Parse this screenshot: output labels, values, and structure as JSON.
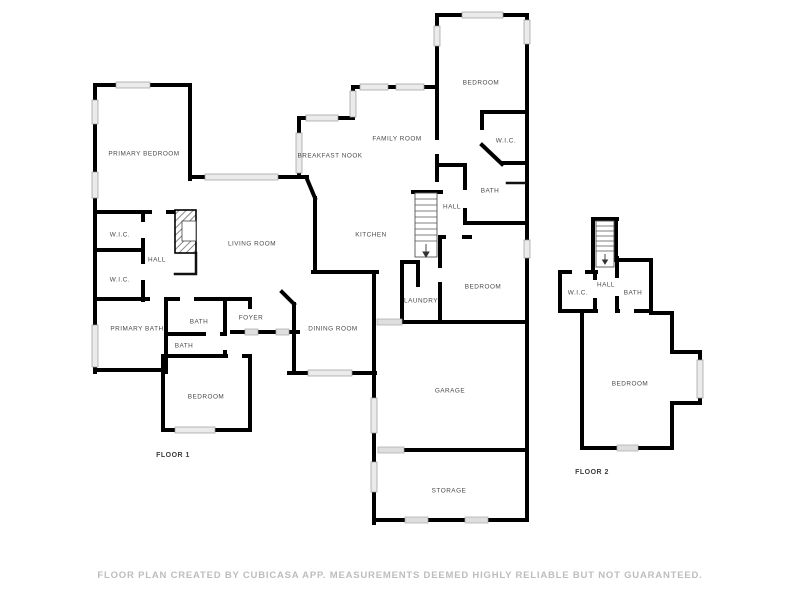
{
  "document": {
    "type": "floor-plan",
    "creator_note": "CUBICASA APP"
  },
  "floors": [
    {
      "name": "FLOOR 1",
      "name_pos": {
        "x": 173,
        "y": 455
      },
      "rooms": [
        {
          "name": "PRIMARY BEDROOM",
          "x": 144,
          "y": 154
        },
        {
          "name": "LIVING ROOM",
          "x": 252,
          "y": 244
        },
        {
          "name": "BEDROOM",
          "x": 481,
          "y": 83
        },
        {
          "name": "W.I.C.",
          "x": 506,
          "y": 141
        },
        {
          "name": "BATH",
          "x": 490,
          "y": 191
        },
        {
          "name": "HALL",
          "x": 452,
          "y": 207
        },
        {
          "name": "FAMILY ROOM",
          "x": 397,
          "y": 139
        },
        {
          "name": "BREAKFAST NOOK",
          "x": 330,
          "y": 156
        },
        {
          "name": "KITCHEN",
          "x": 371,
          "y": 235
        },
        {
          "name": "W.I.C.",
          "x": 120,
          "y": 235
        },
        {
          "name": "HALL",
          "x": 157,
          "y": 260
        },
        {
          "name": "W.I.C.",
          "x": 120,
          "y": 280
        },
        {
          "name": "PRIMARY BATH",
          "x": 137,
          "y": 329
        },
        {
          "name": "BATH",
          "x": 199,
          "y": 322
        },
        {
          "name": "FOYER",
          "x": 251,
          "y": 318
        },
        {
          "name": "BATH",
          "x": 184,
          "y": 346
        },
        {
          "name": "DINING ROOM",
          "x": 333,
          "y": 329
        },
        {
          "name": "LAUNDRY",
          "x": 421,
          "y": 301
        },
        {
          "name": "BEDROOM",
          "x": 483,
          "y": 287
        },
        {
          "name": "BEDROOM",
          "x": 206,
          "y": 397
        },
        {
          "name": "GARAGE",
          "x": 450,
          "y": 391
        },
        {
          "name": "STORAGE",
          "x": 449,
          "y": 491
        }
      ]
    },
    {
      "name": "FLOOR 2",
      "name_pos": {
        "x": 592,
        "y": 472
      },
      "rooms": [
        {
          "name": "W.I.C.",
          "x": 578,
          "y": 293
        },
        {
          "name": "HALL",
          "x": 606,
          "y": 285
        },
        {
          "name": "BATH",
          "x": 633,
          "y": 293
        },
        {
          "name": "BEDROOM",
          "x": 630,
          "y": 384
        }
      ]
    }
  ],
  "symbols": [
    {
      "name": "stairs-floor-1"
    },
    {
      "name": "stairs-floor-2"
    },
    {
      "name": "fireplace"
    }
  ],
  "footer": {
    "text": "FLOOR PLAN CREATED BY CUBICASA APP. MEASUREMENTS DEEMED HIGHLY RELIABLE BUT NOT GUARANTEED."
  },
  "colors": {
    "background": "#ffffff",
    "wall": "#000000",
    "window_fill": "#ebebeb",
    "window_stroke": "#9a9a9a",
    "room_label": "#4a4a4a",
    "floor_label": "#3d3d3d",
    "footer_text": "#bdbdbd"
  }
}
